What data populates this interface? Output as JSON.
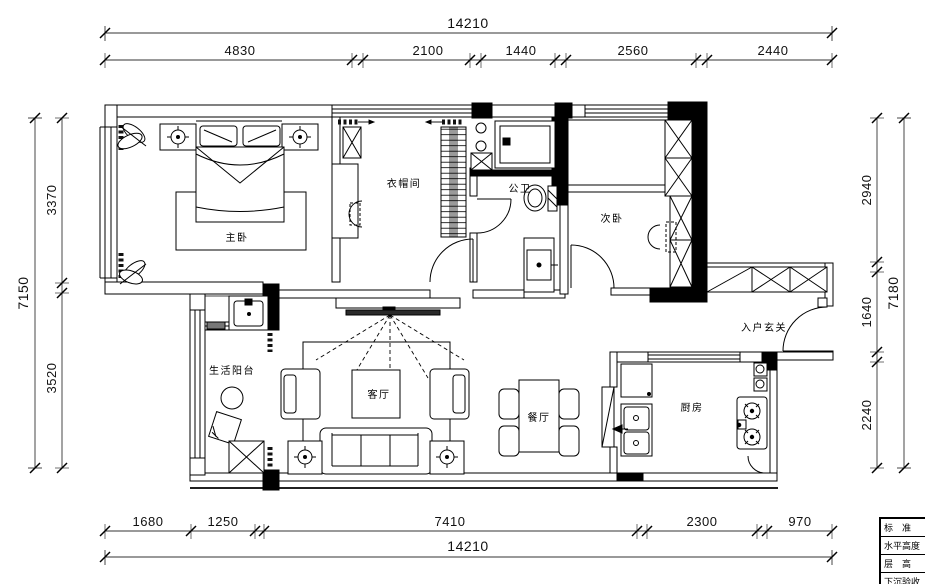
{
  "dims": {
    "top": {
      "overall": "14210",
      "segments": [
        "4830",
        "2100",
        "1440",
        "2560",
        "2440"
      ]
    },
    "bottom": {
      "overall": "14210",
      "segments": [
        "1680",
        "1250",
        "7410",
        "2300",
        "970"
      ]
    },
    "left": {
      "overall": "7150",
      "segments": [
        "3370",
        "3520"
      ]
    },
    "right": {
      "overall": "7180",
      "segments": [
        "2940",
        "1640",
        "2240"
      ]
    }
  },
  "rooms": {
    "master": "主卧",
    "cloak": "衣帽间",
    "bath": "公卫",
    "second": "次卧",
    "balcony": "生活阳台",
    "living": "客厅",
    "dining": "餐厅",
    "kitchen": "厨房",
    "entry": "入户玄关"
  },
  "legend": {
    "rows": [
      "标　准",
      "水平高度",
      "层　高",
      "下沉验收"
    ]
  },
  "colors": {
    "line": "#000000",
    "dim_line": "#333333",
    "wall_fill": "#000000"
  }
}
